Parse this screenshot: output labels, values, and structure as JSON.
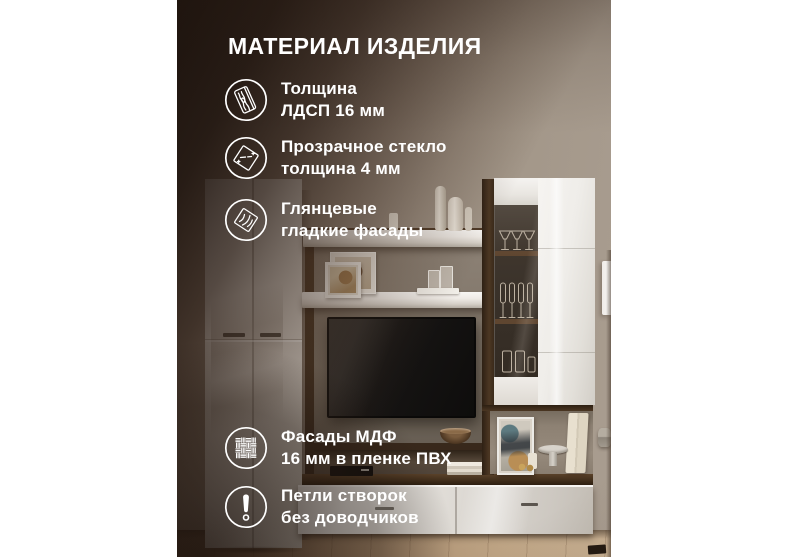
{
  "card": {
    "title": "МАТЕРИАЛ ИЗДЕЛИЯ",
    "features": [
      {
        "icon": "chipboard-plank-icon",
        "line1": "Толщина",
        "line2": "ЛДСП 16 мм"
      },
      {
        "icon": "glass-pane-icon",
        "line1": "Прозрачное стекло",
        "line2": "толщина 4 мм"
      },
      {
        "icon": "glossy-facade-icon",
        "line1": "Глянцевые",
        "line2": "гладкие фасады"
      },
      {
        "icon": "mdf-weave-icon",
        "line1": "Фасады МДФ",
        "line2": "16 мм в пленке ПВХ"
      },
      {
        "icon": "warning-icon",
        "line1": "Петли створок",
        "line2": "без доводчиков"
      }
    ],
    "colors": {
      "text": "#ffffff",
      "overlay_brown": "#2a1a12",
      "wall": "#9c9083",
      "walnut_wood": "#46331f",
      "facade_white": "#efede9",
      "floor_wood": "#a98d6f"
    }
  }
}
